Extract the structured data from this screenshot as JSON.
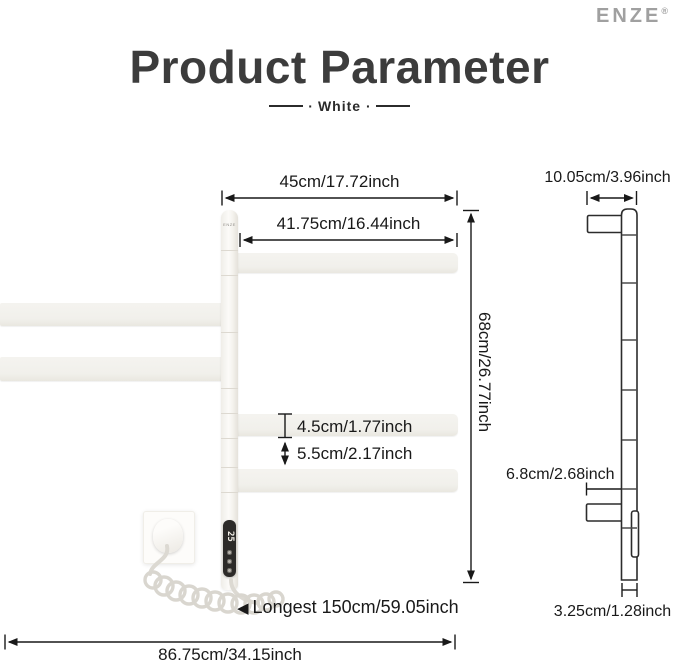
{
  "brand": {
    "name": "ENZE",
    "mark": "®",
    "pole_label": "ENZE"
  },
  "header": {
    "title": "Product Parameter",
    "subtitle": "White",
    "dot": "·"
  },
  "front_view": {
    "display_value": "25",
    "measurements": {
      "top_width": "45cm/17.72inch",
      "bar_length": "41.75cm/16.44inch",
      "height": "68cm/26.77inch",
      "bar_thickness": "4.5cm/1.77inch",
      "bar_gap": "5.5cm/2.17inch",
      "cord_pointer": "◀",
      "cord_length": "Longest 150cm/59.05inch",
      "total_width": "86.75cm/34.15inch"
    }
  },
  "side_view": {
    "measurements": {
      "top_depth": "10.05cm/3.96inch",
      "arm_depth": "6.8cm/2.68inch",
      "pole_depth": "3.25cm/1.28inch"
    }
  },
  "colors": {
    "line": "#191919",
    "title": "#3c3c3c",
    "logo_gray": "#a0a0a0",
    "product_white": "#f1f0eb",
    "panel_black": "#2d2b29"
  }
}
